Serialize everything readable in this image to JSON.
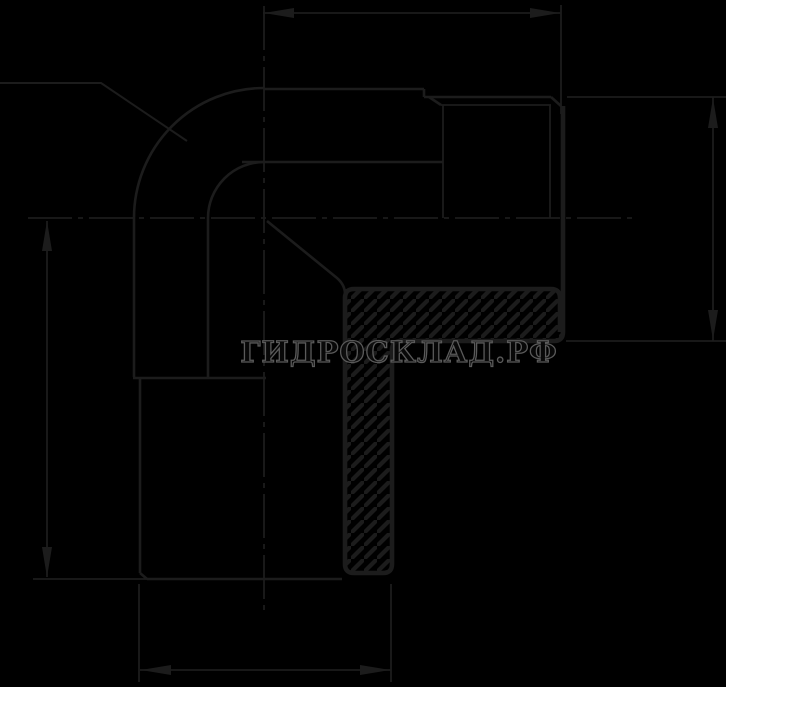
{
  "window": {
    "width": 799,
    "height": 712
  },
  "drawing_area": {
    "width": 726,
    "height": 687,
    "background": "#000000",
    "page_background": "#ffffff"
  },
  "colors": {
    "line": "#1c1c1c",
    "hatch": "#1c1c1c",
    "watermark_outline": "#5a5a5a",
    "watermark_fill": "rgba(10,10,10,0.78)"
  },
  "watermark": {
    "text": "ГИДРОСКЛАД.РФ"
  },
  "drawing": {
    "line_widths": {
      "thin": 1.8,
      "outline": 2.6,
      "section": 4.6
    },
    "centerline_dash": "44 6 5 6",
    "centerlines": [
      [
        28,
        218,
        633,
        218
      ],
      [
        264,
        6,
        264,
        616
      ]
    ],
    "dimension_lines": [
      [
        263,
        13,
        561,
        13
      ],
      [
        713,
        97,
        713,
        341
      ],
      [
        47,
        221,
        47,
        577
      ],
      [
        140,
        670,
        391,
        670
      ]
    ],
    "extension_lines": [
      [
        561,
        5,
        561,
        114
      ],
      [
        567,
        97,
        726,
        97
      ],
      [
        566,
        341,
        726,
        341
      ],
      [
        33,
        579,
        147,
        579
      ],
      [
        139,
        584,
        139,
        682
      ],
      [
        391,
        584,
        391,
        682
      ]
    ],
    "arrows": [
      {
        "tip": [
          264,
          13
        ],
        "dir": "left"
      },
      {
        "tip": [
          560,
          13
        ],
        "dir": "right"
      },
      {
        "tip": [
          713,
          98
        ],
        "dir": "up"
      },
      {
        "tip": [
          713,
          340
        ],
        "dir": "down"
      },
      {
        "tip": [
          47,
          221
        ],
        "dir": "up"
      },
      {
        "tip": [
          47,
          577
        ],
        "dir": "down"
      },
      {
        "tip": [
          141,
          670
        ],
        "dir": "left"
      },
      {
        "tip": [
          390,
          670
        ],
        "dir": "right"
      }
    ],
    "outline_lines": [
      [
        264,
        89,
        424,
        89
      ],
      [
        424,
        89,
        424,
        97
      ],
      [
        424,
        97,
        551,
        97
      ],
      [
        429,
        97,
        441,
        105
      ],
      [
        551,
        97,
        561,
        106
      ],
      [
        242,
        162,
        443,
        162
      ],
      [
        134,
        218,
        134,
        377
      ],
      [
        208,
        218,
        208,
        377
      ],
      [
        133,
        378,
        266,
        378
      ],
      [
        140,
        379,
        140,
        573
      ],
      [
        140,
        573,
        147,
        579
      ],
      [
        147,
        579,
        342,
        579
      ]
    ],
    "thin_lines": [
      [
        441,
        105,
        551,
        105
      ],
      [
        443,
        105,
        443,
        218
      ],
      [
        550,
        105,
        550,
        218
      ]
    ],
    "paths": [
      {
        "name": "outer-arc",
        "d": "M134,218 A130,130 0 0 1 264,88",
        "w": 2.6
      },
      {
        "name": "inner-arc",
        "d": "M208,218 A56,56 0 0 1 264,162",
        "w": 2.6
      },
      {
        "name": "leader-line",
        "d": "M0,83 L101,83 L187,141",
        "w": 2
      },
      {
        "name": "bore-cone-line",
        "d": "M267,221 L337,278 Q345,285 345,294",
        "w": 2.6
      },
      {
        "name": "section-outline",
        "d": "M563,106 L563,332 Q563,341 554,341 L401,341 Q392,341 392,350 L392,564 Q392,573 383,573 L354,573 Q345,573 345,564 L345,298 Q345,289 354,289 L551,289 Q560,289 560,298 L560,332",
        "w": 4.6
      }
    ],
    "hatch_rects": [
      [
        345,
        289,
        216,
        52
      ],
      [
        345,
        341,
        47,
        232
      ]
    ]
  }
}
